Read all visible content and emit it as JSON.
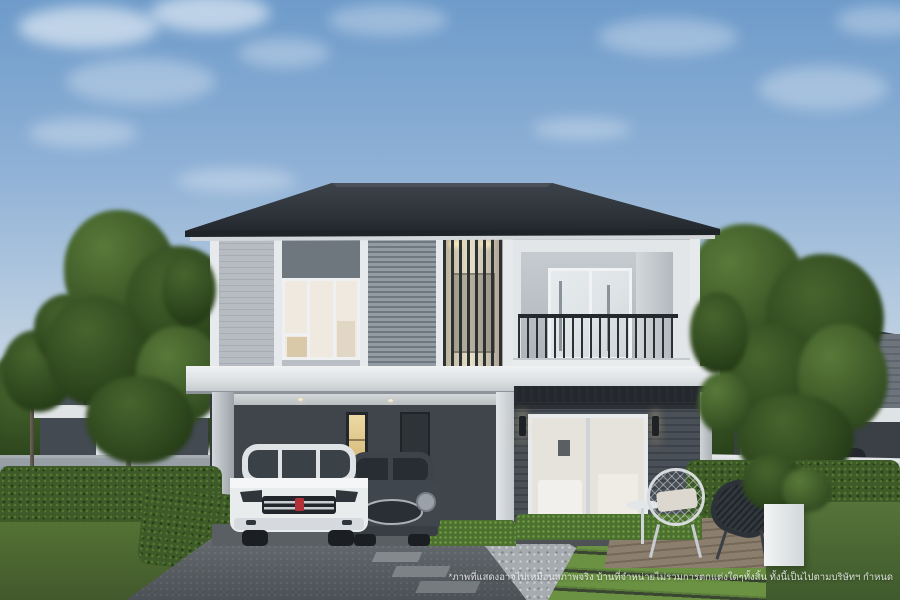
{
  "scene": {
    "type": "architectural-rendering",
    "subject": "modern two-story detached house with carport, two parked cars, landscaped front yard and neighboring houses",
    "watermark_text": "*ภาพที่แสดงอาจไม่เหมือนสภาพจริง บ้านที่จำหน่ายไม่รวมการตกแต่งใดๆทั้งสิ้น ทั้งนี้เป็นไปตามบริษัทฯ กำหนด"
  },
  "colors": {
    "sky_top": "#6e9bca",
    "sky_horizon": "#dfe6ea",
    "roof": "#343a41",
    "trim": "#e7eaec",
    "siding_light": "#b7bdc3",
    "siding_blind": "#8d959d",
    "wall_dark": "#474d54",
    "carport_interior": "#363b41",
    "grass": "#5f8137",
    "hedge": "#3d5a28",
    "driveway": "#5d6267",
    "gravel": "#a6abaf",
    "deck": "#84786a",
    "suv_body": "#e9eced",
    "mini_body": "#40464d",
    "accent_badge": "#b23038",
    "warm_light": "#d9b878"
  }
}
